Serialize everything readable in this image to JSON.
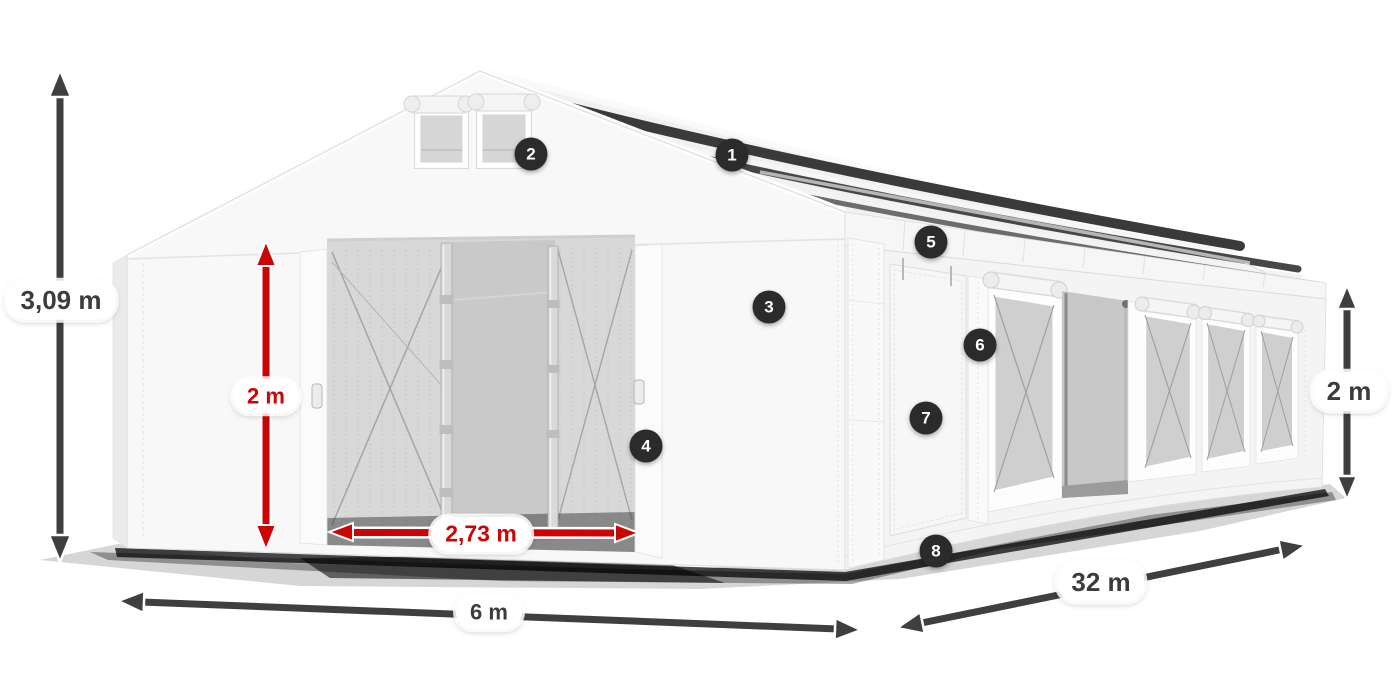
{
  "diagram": {
    "type": "product-dimension-diagram",
    "subject": "white marquee storage tent with open front doors, mesh windows and numbered feature markers",
    "dimensions": {
      "total_height": {
        "value": "3,09 m"
      },
      "door_height": {
        "value": "2 m"
      },
      "door_width": {
        "value": "2,73 m"
      },
      "front_width": {
        "value": "6 m"
      },
      "side_length": {
        "value": "32 m"
      },
      "side_height": {
        "value": "2 m"
      }
    },
    "markers": [
      {
        "number": "1"
      },
      {
        "number": "2"
      },
      {
        "number": "3"
      },
      {
        "number": "4"
      },
      {
        "number": "5"
      },
      {
        "number": "6"
      },
      {
        "number": "7"
      },
      {
        "number": "8"
      }
    ],
    "colors": {
      "dimension_red": "#cc0404",
      "dimension_gray": "#3f3f3f",
      "marker_background": "#2b2b2b",
      "marker_text": "#ffffff",
      "label_background": "#ffffff",
      "tent_white": "#f7f7f7",
      "roof_brace_dark": "#3a3a3a"
    }
  }
}
